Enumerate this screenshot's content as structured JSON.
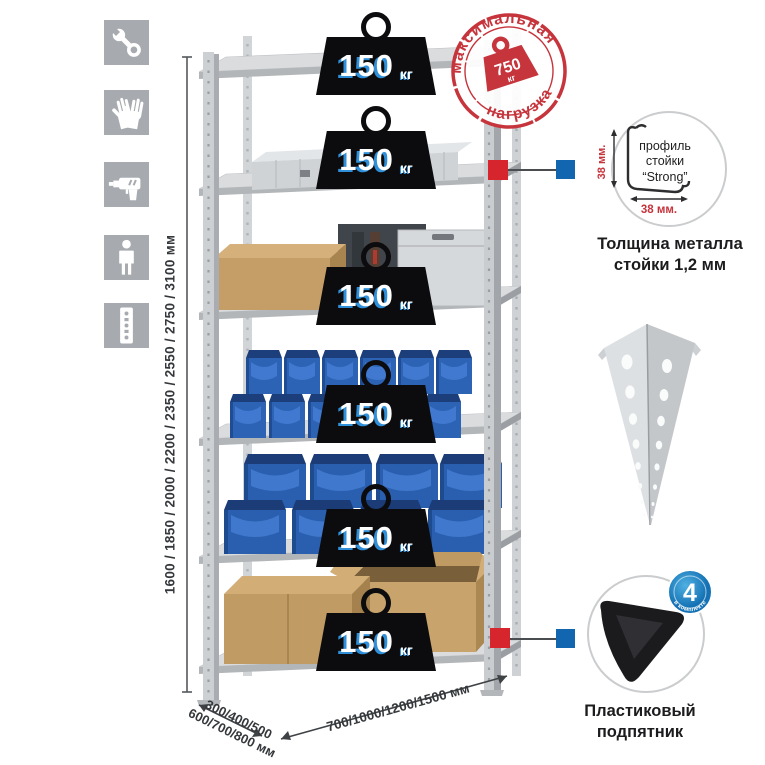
{
  "stamp": {
    "arc_top": "максимальная",
    "arc_bottom": "нагрузка",
    "value": "750",
    "unit": "кг"
  },
  "weights": [
    {
      "value": "150",
      "unit": "кг"
    },
    {
      "value": "150",
      "unit": "кг"
    },
    {
      "value": "150",
      "unit": "кг"
    },
    {
      "value": "150",
      "unit": "кг"
    },
    {
      "value": "150",
      "unit": "кг"
    },
    {
      "value": "150",
      "unit": "кг"
    }
  ],
  "dimensions": {
    "height": "1600 / 1850 / 2000 / 2200 / 2350 / 2550 / 2750 / 3100 мм",
    "depth_line1": "300/400/500",
    "depth_line2": "600/700/800 мм",
    "width": "700/1000/1200/1500 мм"
  },
  "profile_detail": {
    "label_line1": "профиль",
    "label_line2": "стойки",
    "label_line3": "“Strong”",
    "dim_vertical": "38 мм.",
    "dim_horizontal": "38 мм.",
    "caption_line1": "Толщина металла",
    "caption_line2": "стойки 1,2 мм"
  },
  "foot_detail": {
    "badge_number": "4",
    "badge_arc": "в комплекте",
    "badge_sparkle": "✦",
    "caption_line1": "Пластиковый",
    "caption_line2": "подпятник"
  },
  "icons": [
    "wrench",
    "gloves",
    "drill",
    "person",
    "rack-post"
  ],
  "colors": {
    "stamp_red": "#c6343c",
    "marker_red": "#d6252c",
    "marker_blue": "#1266b0",
    "icon_bg": "#a7abb0",
    "bin_blue": "#2c63b5",
    "metal_gray": "#ccd0d3",
    "cardboard": "#c19b64",
    "weight_black": "#0c0c0e",
    "weight_shadow_blue": "#2f8fd8",
    "badge_blue": "#1472b4"
  }
}
